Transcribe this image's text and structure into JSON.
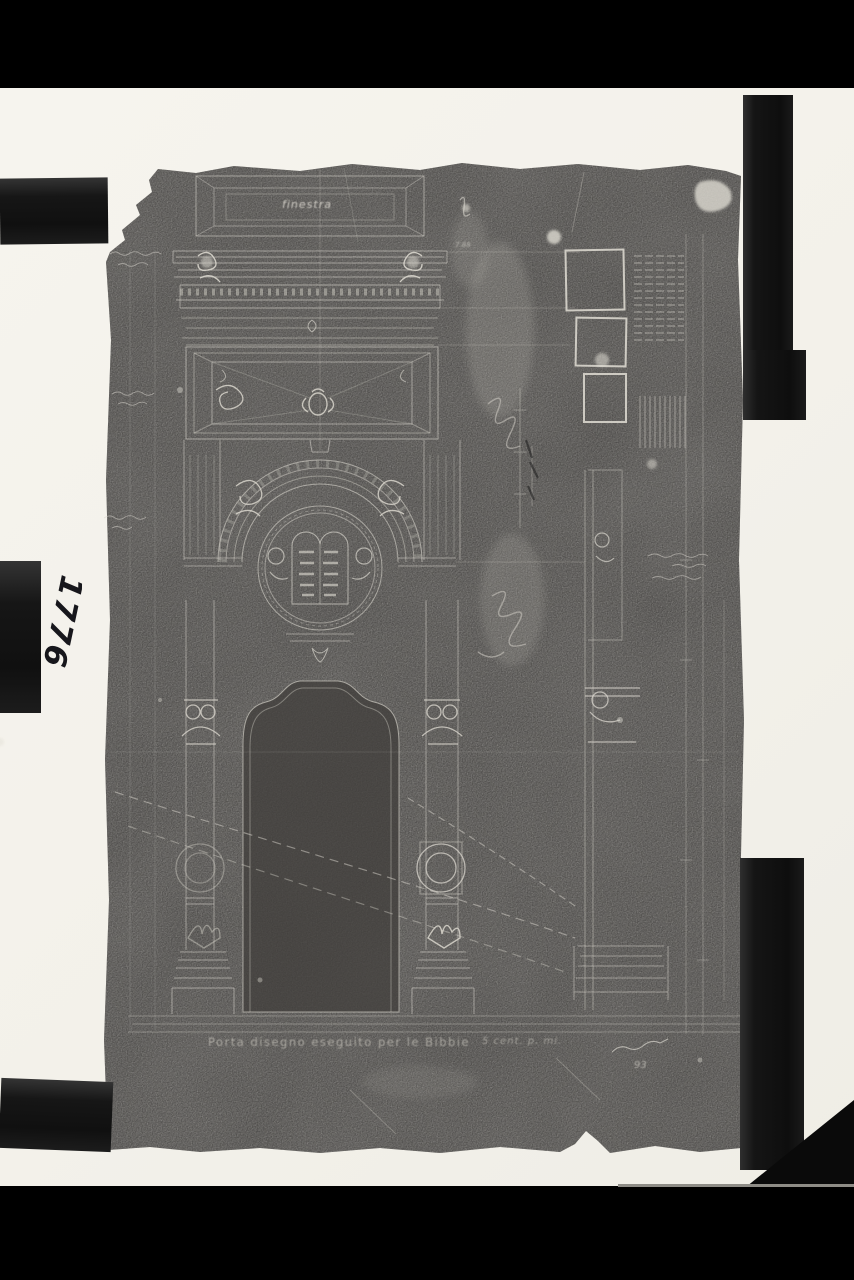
{
  "page": {
    "background_color": "#000000",
    "mount_color": "#f4f2ec",
    "photo_emulsion_color": "#4a4846",
    "line_color": "#d9d6cd"
  },
  "archive": {
    "inventory_number": "1776"
  },
  "photo": {
    "description": "negative photograph of an architectural portal drawing mounted with black clamps",
    "labels": {
      "window": "finestra",
      "detail_ref": "7.88",
      "title": "Porta disegno eseguito per le Bibbie",
      "scale": "5 cent. p. mi.",
      "signature_year": "93"
    },
    "annotations": {
      "left_top": "(nota manoscritta illeggibile)",
      "left_middle": "(nota manoscritta illeggibile)",
      "left_lower": "(nota manoscritta illeggibile)",
      "right_middle": "(nota manoscritta illeggibile)",
      "tablets": "(iscrizione sulle Tavole della Legge)"
    }
  }
}
